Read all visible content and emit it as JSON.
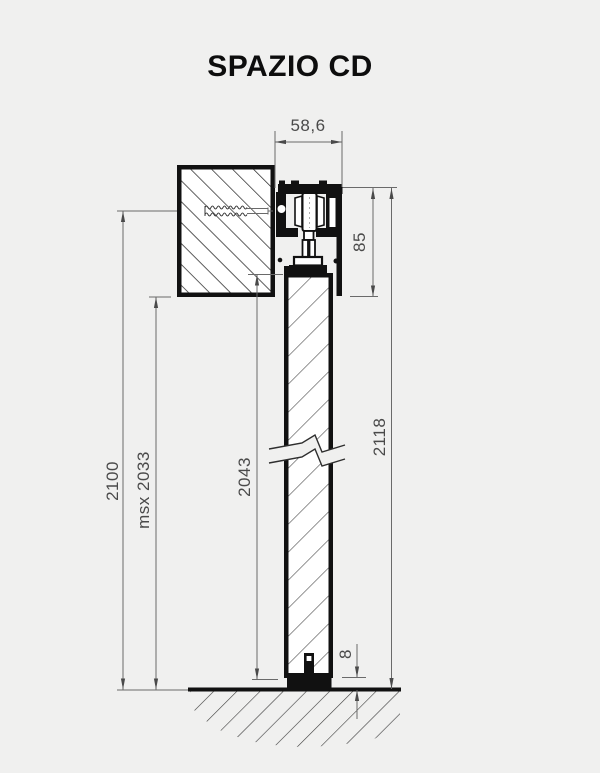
{
  "title": "SPAZIO CD",
  "drawing": {
    "type": "technical-section",
    "subject": "sliding door system vertical section",
    "dims": {
      "track_width": "58,6",
      "mechanism_height": "85",
      "total_height": "2118",
      "door_panel_height": "2043",
      "opening_height": "2100",
      "max_height": "msx 2033",
      "floor_gap": "8"
    },
    "parts": [
      "wall-section",
      "anchor-screw",
      "top-track-profile",
      "roller-carriage",
      "hanger-bracket",
      "fascia-cover",
      "door-panel",
      "break-symbol",
      "bottom-floor-guide",
      "floor-line",
      "ground-hatch"
    ],
    "colors": {
      "background": "#f0f0ef",
      "drawing_line": "#111111",
      "dimension_line": "#6a6a6a",
      "dimension_text": "#4a4a4a",
      "hatch": "#1b1b1b"
    }
  }
}
